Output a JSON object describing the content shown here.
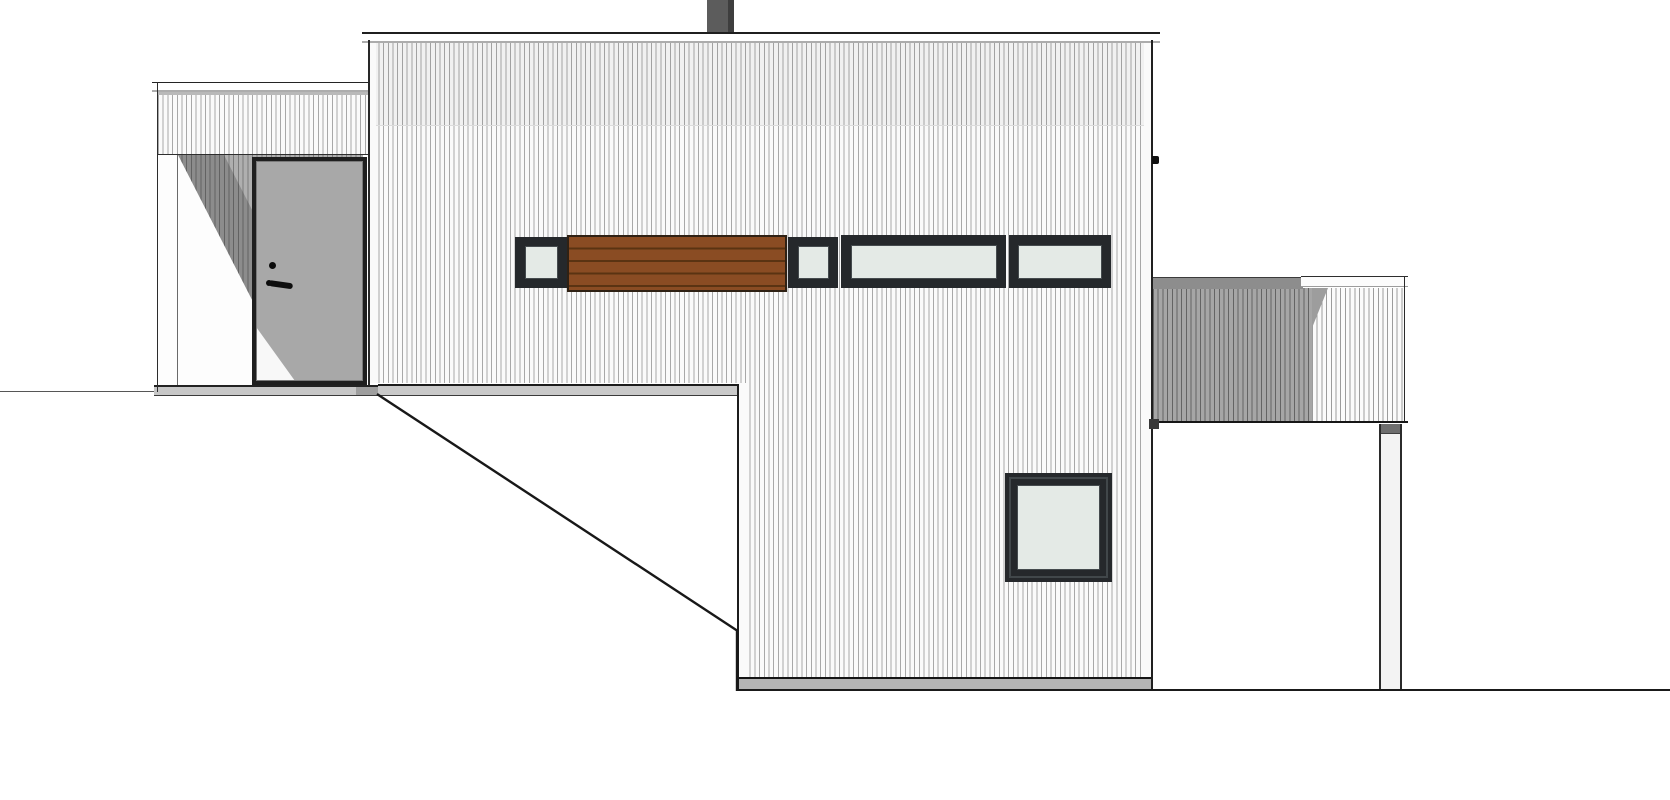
{
  "document": {
    "type": "architectural-elevation-drawing",
    "view": "side-elevation-of-house"
  },
  "palette": {
    "line": "#1f1f1f",
    "facade-bg": "#fafafa",
    "stripe": "#a8a8a8",
    "cap-shadow": "#acacac",
    "glass": "#e4eae6",
    "frame-dark": "#25282b",
    "frame-bevel": "#454b4e",
    "wood": "#8a4c23",
    "wood-line": "#5a3312",
    "wood-edge": "#2f2114",
    "door-gray": "#a8a8a8",
    "porch-bg": "#afafaf",
    "chimney": "#5c5c5c",
    "chimney-dark": "#3e3e3e",
    "base-strip": "#c7c7c7",
    "base-strip-lower": "#b4b4b4",
    "deck-dark": "#a6a6a6",
    "deck-cap-dark": "#8d8d8d",
    "ground": "#1a1a1a"
  },
  "parts": [
    "chimney",
    "main-roof-cap",
    "main-facade-vertical-siding",
    "facade-joint-line",
    "clerestory-window-1",
    "wood-slat-panel",
    "clerestory-window-2",
    "clerestory-window-3",
    "clerestory-window-4",
    "square-window",
    "annex-roof-cap",
    "annex-facade",
    "entry-porch-recess",
    "porch-shadow-wedge",
    "porch-corner-post",
    "entry-door",
    "door-peephole",
    "door-handle",
    "annex-base-strip",
    "main-base-strip-left",
    "main-base-strip-lower",
    "deck-roof-cap",
    "deck-siding-shaded",
    "deck-siding-light",
    "deck-support-post",
    "wall-edge-bracket-tick",
    "deck-wall-junction-mark",
    "ground-line-left",
    "ground-slope-line",
    "ground-line-right"
  ]
}
